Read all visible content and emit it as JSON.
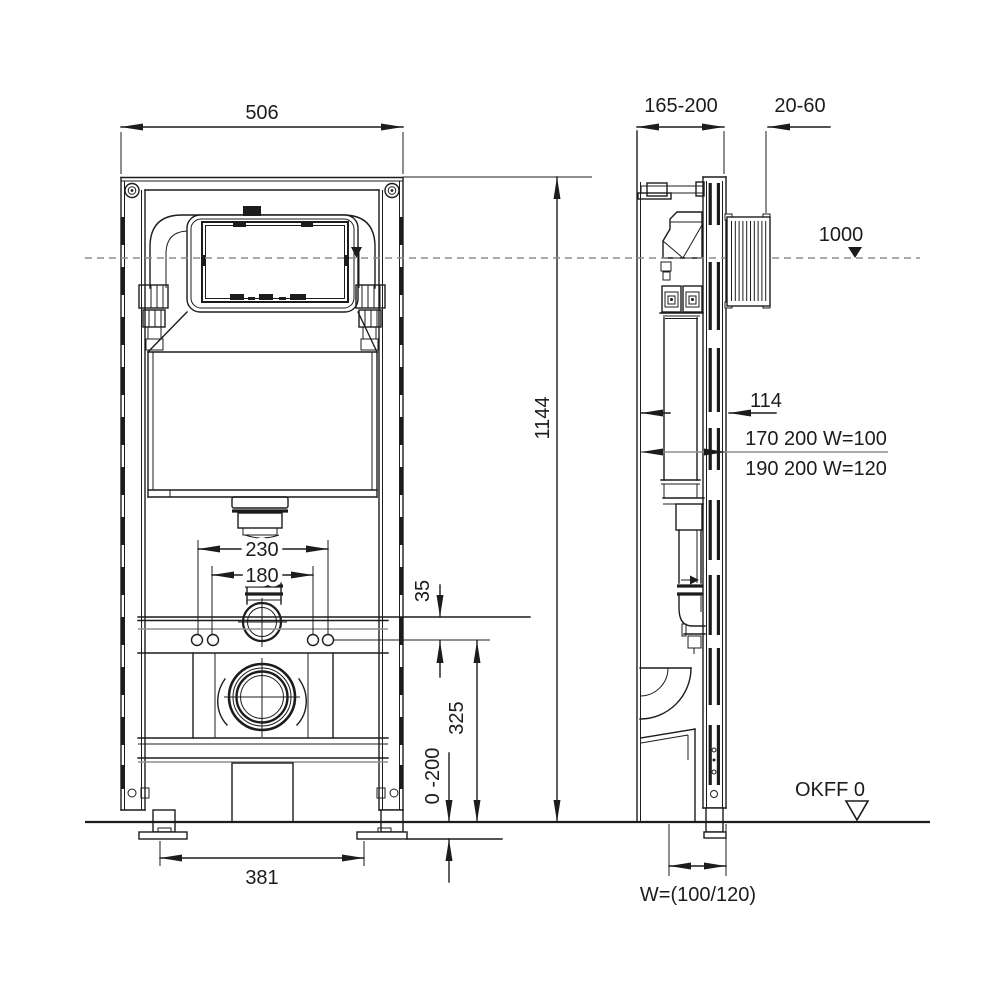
{
  "front_view": {
    "width": "506",
    "height": "1144",
    "flush_pipe_spacing_outer": "230",
    "flush_pipe_spacing_inner": "180",
    "bracket_offset": "35",
    "drain_center_height": "325",
    "leg_adjustment": "0 -200",
    "foot_spacing": "381"
  },
  "side_view": {
    "mounting_depth": "165-200",
    "wall_finish_depth": "20-60",
    "panel_center_height": "1000",
    "cistern_depth": "114",
    "flush_pipe_note_w100": "170 200 W=100",
    "flush_pipe_note_w120": "190 200 W=120",
    "floor_level_label": "OKFF 0",
    "drain_pipe_width": "W=(100/120)"
  }
}
